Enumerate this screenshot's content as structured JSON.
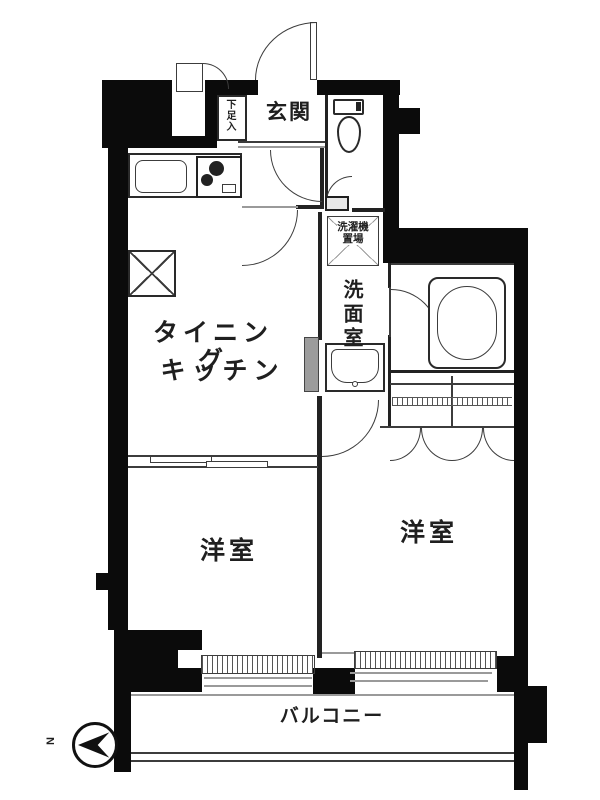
{
  "plan": {
    "type": "apartment-floor-plan",
    "labels": {
      "entrance": "玄関",
      "shoe_cabinet": "下足入",
      "dining_line1": "タイニング",
      "dining_line2": "キッチン",
      "washer_line1": "洗濯機",
      "washer_line2": "置場",
      "washroom": "洗面室",
      "bedroom_left": "洋室",
      "bedroom_right": "洋室",
      "balcony": "バルコニー",
      "compass_north": "N"
    },
    "colors": {
      "wall": "#0b0b0b",
      "line": "#3c3c3c",
      "text": "#1f1f1f",
      "background": "#ffffff",
      "shade": "#9c9c9c"
    }
  }
}
